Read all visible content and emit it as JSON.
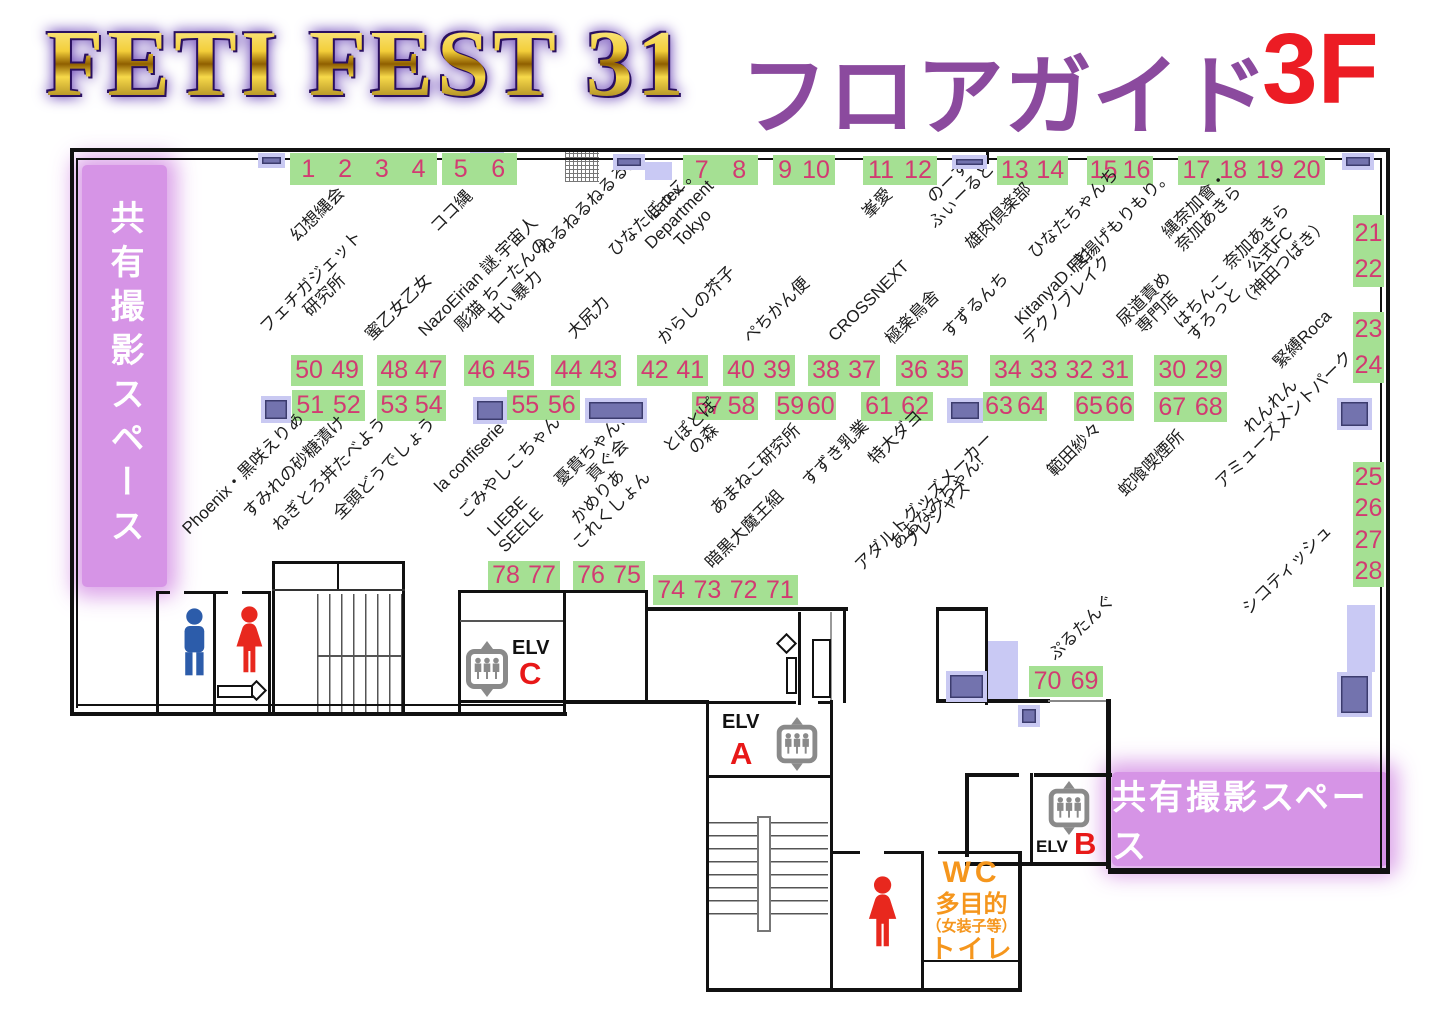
{
  "title": {
    "event": "FETI FEST 31",
    "guide": "フロアガイド",
    "floor": "3F"
  },
  "areas": {
    "left": "共有撮影スペース",
    "right": "共有撮影スペース"
  },
  "colors": {
    "booth_green": "#a5e093",
    "booth_number": "#d23b72",
    "pillar": "#7373ae",
    "pillar_border": "#c9c9f2",
    "band_purple": "#d694e6",
    "title_purple": "#8b4a9e",
    "title_red": "#ec1c24",
    "wc_orange": "#f5961d",
    "elv_letter_red": "#e81818",
    "male_blue": "#2c5caa",
    "female_red": "#e8281e"
  },
  "booths": [
    {
      "nums": [
        "1",
        "2",
        "3",
        "4"
      ],
      "x": 290,
      "y": 153,
      "w": 147,
      "h": 32,
      "dir": "h"
    },
    {
      "nums": [
        "5",
        "6"
      ],
      "x": 442,
      "y": 153,
      "w": 75,
      "h": 32,
      "dir": "h"
    },
    {
      "nums": [
        "7",
        "8"
      ],
      "x": 683,
      "y": 155,
      "w": 75,
      "h": 30,
      "dir": "h"
    },
    {
      "nums": [
        "9",
        "10"
      ],
      "x": 773,
      "y": 155,
      "w": 62,
      "h": 30,
      "dir": "h"
    },
    {
      "nums": [
        "11",
        "12"
      ],
      "x": 863,
      "y": 156,
      "w": 74,
      "h": 29,
      "dir": "h"
    },
    {
      "nums": [
        "13",
        "14"
      ],
      "x": 997,
      "y": 156,
      "w": 71,
      "h": 29,
      "dir": "h"
    },
    {
      "nums": [
        "15",
        "16"
      ],
      "x": 1087,
      "y": 156,
      "w": 66,
      "h": 29,
      "dir": "h"
    },
    {
      "nums": [
        "17",
        "18",
        "19",
        "20"
      ],
      "x": 1178,
      "y": 156,
      "w": 147,
      "h": 29,
      "dir": "h"
    },
    {
      "nums": [
        "21",
        "22"
      ],
      "x": 1353,
      "y": 215,
      "w": 31,
      "h": 72,
      "dir": "v"
    },
    {
      "nums": [
        "23",
        "24"
      ],
      "x": 1353,
      "y": 312,
      "w": 31,
      "h": 71,
      "dir": "v"
    },
    {
      "nums": [
        "25",
        "26",
        "27",
        "28"
      ],
      "x": 1353,
      "y": 462,
      "w": 31,
      "h": 125,
      "dir": "v"
    },
    {
      "nums": [
        "50",
        "49"
      ],
      "x": 291,
      "y": 355,
      "w": 72,
      "h": 31,
      "dir": "h"
    },
    {
      "nums": [
        "48",
        "47"
      ],
      "x": 377,
      "y": 355,
      "w": 69,
      "h": 31,
      "dir": "h"
    },
    {
      "nums": [
        "46",
        "45"
      ],
      "x": 464,
      "y": 355,
      "w": 70,
      "h": 31,
      "dir": "h"
    },
    {
      "nums": [
        "44",
        "43"
      ],
      "x": 551,
      "y": 355,
      "w": 70,
      "h": 31,
      "dir": "h"
    },
    {
      "nums": [
        "42",
        "41"
      ],
      "x": 637,
      "y": 355,
      "w": 71,
      "h": 31,
      "dir": "h"
    },
    {
      "nums": [
        "40",
        "39"
      ],
      "x": 723,
      "y": 355,
      "w": 72,
      "h": 31,
      "dir": "h"
    },
    {
      "nums": [
        "38",
        "37"
      ],
      "x": 808,
      "y": 355,
      "w": 72,
      "h": 31,
      "dir": "h"
    },
    {
      "nums": [
        "36",
        "35"
      ],
      "x": 896,
      "y": 355,
      "w": 72,
      "h": 31,
      "dir": "h"
    },
    {
      "nums": [
        "34",
        "33",
        "32",
        "31"
      ],
      "x": 990,
      "y": 355,
      "w": 143,
      "h": 31,
      "dir": "h"
    },
    {
      "nums": [
        "30",
        "29"
      ],
      "x": 1154,
      "y": 355,
      "w": 73,
      "h": 31,
      "dir": "h"
    },
    {
      "nums": [
        "51",
        "52"
      ],
      "x": 292,
      "y": 390,
      "w": 73,
      "h": 31,
      "dir": "h"
    },
    {
      "nums": [
        "53",
        "54"
      ],
      "x": 377,
      "y": 390,
      "w": 69,
      "h": 31,
      "dir": "h"
    },
    {
      "nums": [
        "55",
        "56"
      ],
      "x": 507,
      "y": 390,
      "w": 73,
      "h": 30,
      "dir": "h"
    },
    {
      "nums": [
        "57",
        "58"
      ],
      "x": 692,
      "y": 392,
      "w": 66,
      "h": 28,
      "dir": "h"
    },
    {
      "nums": [
        "59",
        "60"
      ],
      "x": 775,
      "y": 392,
      "w": 61,
      "h": 28,
      "dir": "h"
    },
    {
      "nums": [
        "61",
        "62"
      ],
      "x": 861,
      "y": 392,
      "w": 72,
      "h": 29,
      "dir": "h"
    },
    {
      "nums": [
        "63",
        "64"
      ],
      "x": 983,
      "y": 392,
      "w": 64,
      "h": 29,
      "dir": "h"
    },
    {
      "nums": [
        "65",
        "66"
      ],
      "x": 1074,
      "y": 392,
      "w": 60,
      "h": 29,
      "dir": "h"
    },
    {
      "nums": [
        "67",
        "68"
      ],
      "x": 1154,
      "y": 392,
      "w": 73,
      "h": 30,
      "dir": "h"
    },
    {
      "nums": [
        "78",
        "77"
      ],
      "x": 488,
      "y": 561,
      "w": 72,
      "h": 29,
      "dir": "h"
    },
    {
      "nums": [
        "76",
        "75"
      ],
      "x": 573,
      "y": 561,
      "w": 72,
      "h": 29,
      "dir": "h"
    },
    {
      "nums": [
        "74",
        "73",
        "72",
        "71"
      ],
      "x": 653,
      "y": 575,
      "w": 145,
      "h": 30,
      "dir": "h"
    },
    {
      "nums": [
        "70",
        "69"
      ],
      "x": 1029,
      "y": 666,
      "w": 74,
      "h": 31,
      "dir": "h"
    }
  ],
  "circles": [
    {
      "lines": [
        "幻想縄会"
      ],
      "x": 300,
      "y": 245
    },
    {
      "lines": [
        "ココ縄"
      ],
      "x": 440,
      "y": 236
    },
    {
      "lines": [
        "ねるねるねるる。"
      ],
      "x": 548,
      "y": 258
    },
    {
      "lines": [
        "ひなたぼっこ。"
      ],
      "x": 618,
      "y": 260
    },
    {
      "lines": [
        "Latex",
        "Department",
        "Tokyo"
      ],
      "x": 668,
      "y": 266
    },
    {
      "lines": [
        "峯愛"
      ],
      "x": 872,
      "y": 222
    },
    {
      "lines": [
        "のーす",
        "ふぃーるど"
      ],
      "x": 938,
      "y": 232
    },
    {
      "lines": [
        "雄肉倶楽部"
      ],
      "x": 975,
      "y": 253
    },
    {
      "lines": [
        "ひなたちゃんち"
      ],
      "x": 1038,
      "y": 262
    },
    {
      "lines": [
        "唐揚げもりもり。"
      ],
      "x": 1080,
      "y": 275
    },
    {
      "lines": [
        "縄奈加會・",
        "奈加あきら"
      ],
      "x": 1185,
      "y": 255
    },
    {
      "lines": [
        "奈加あきら",
        "公式FC",
        "（神田つばき）"
      ],
      "x": 1248,
      "y": 312
    },
    {
      "lines": [
        "緊縛Roca"
      ],
      "x": 1283,
      "y": 372
    },
    {
      "lines": [
        "れんれん",
        "アミューズメントパーク"
      ],
      "x": 1225,
      "y": 492
    },
    {
      "lines": [
        "シコティッシュ"
      ],
      "x": 1252,
      "y": 618
    },
    {
      "lines": [
        "フェチガジェット",
        "研究所"
      ],
      "x": 283,
      "y": 350
    },
    {
      "lines": [
        "蜜乙女乙女"
      ],
      "x": 375,
      "y": 344
    },
    {
      "lines": [
        "NazoEirian 謎.宇宙人"
      ],
      "x": 428,
      "y": 340
    },
    {
      "lines": [
        "彫猫 ちーたんの",
        "甘い暴力"
      ],
      "x": 478,
      "y": 348
    },
    {
      "lines": [
        "大尻力"
      ],
      "x": 577,
      "y": 342
    },
    {
      "lines": [
        "からしの芥子"
      ],
      "x": 667,
      "y": 348
    },
    {
      "lines": [
        "ぺちかん便"
      ],
      "x": 753,
      "y": 347
    },
    {
      "lines": [
        "CROSSNEXT"
      ],
      "x": 838,
      "y": 345
    },
    {
      "lines": [
        "極楽鳥舎"
      ],
      "x": 895,
      "y": 348
    },
    {
      "lines": [
        "すずるんち"
      ],
      "x": 952,
      "y": 342
    },
    {
      "lines": [
        "KitanyaD.Fと",
        "テクノブレイク"
      ],
      "x": 1032,
      "y": 348
    },
    {
      "lines": [
        "尿道責め",
        "専門店"
      ],
      "x": 1140,
      "y": 343
    },
    {
      "lines": [
        "はちんこ",
        "すろっと"
      ],
      "x": 1197,
      "y": 345
    },
    {
      "lines": [
        "Phoenix・黒咲えりあ"
      ],
      "x": 192,
      "y": 538
    },
    {
      "lines": [
        "すみれの砂糖漬け"
      ],
      "x": 253,
      "y": 522
    },
    {
      "lines": [
        "ねぎとろ丼たべよう"
      ],
      "x": 282,
      "y": 535
    },
    {
      "lines": [
        "全頭どうでしょう"
      ],
      "x": 343,
      "y": 523
    },
    {
      "lines": [
        "la confiserie"
      ],
      "x": 444,
      "y": 496
    },
    {
      "lines": [
        "ごみやしこちゃん"
      ],
      "x": 468,
      "y": 522
    },
    {
      "lines": [
        "LIEBE",
        "SEELE"
      ],
      "x": 508,
      "y": 556
    },
    {
      "lines": [
        "憂貴ちゃんに",
        "貢ぐ会"
      ],
      "x": 578,
      "y": 503
    },
    {
      "lines": [
        "かめりあ",
        "これくしょん"
      ],
      "x": 582,
      "y": 553
    },
    {
      "lines": [
        "とぽとぽ",
        "の森"
      ],
      "x": 686,
      "y": 470
    },
    {
      "lines": [
        "あまねこ研究所"
      ],
      "x": 720,
      "y": 518
    },
    {
      "lines": [
        "暗黒大魔王組"
      ],
      "x": 715,
      "y": 572
    },
    {
      "lines": [
        "すずき乳業"
      ],
      "x": 812,
      "y": 490
    },
    {
      "lines": [
        "特大ダヨ"
      ],
      "x": 878,
      "y": 468
    },
    {
      "lines": [
        "あおなみちゃん!"
      ],
      "x": 900,
      "y": 553
    },
    {
      "lines": [
        "アダルトグッズメーカー",
        "プレシャス"
      ],
      "x": 878,
      "y": 588
    },
    {
      "lines": [
        "範田紗々"
      ],
      "x": 1057,
      "y": 480
    },
    {
      "lines": [
        "蛇喰喫煙所"
      ],
      "x": 1128,
      "y": 500
    },
    {
      "lines": [
        "ぷるたんぐ"
      ],
      "x": 1058,
      "y": 664
    }
  ],
  "facilities": {
    "elevator_label": "ELV",
    "elevators": [
      {
        "letter": "A"
      },
      {
        "letter": "B"
      },
      {
        "letter": "C"
      }
    ],
    "wc_lines": [
      "WC",
      "多目的",
      "（女装子等）",
      "トイレ"
    ],
    "toilets": [
      "male",
      "female",
      "female"
    ]
  }
}
